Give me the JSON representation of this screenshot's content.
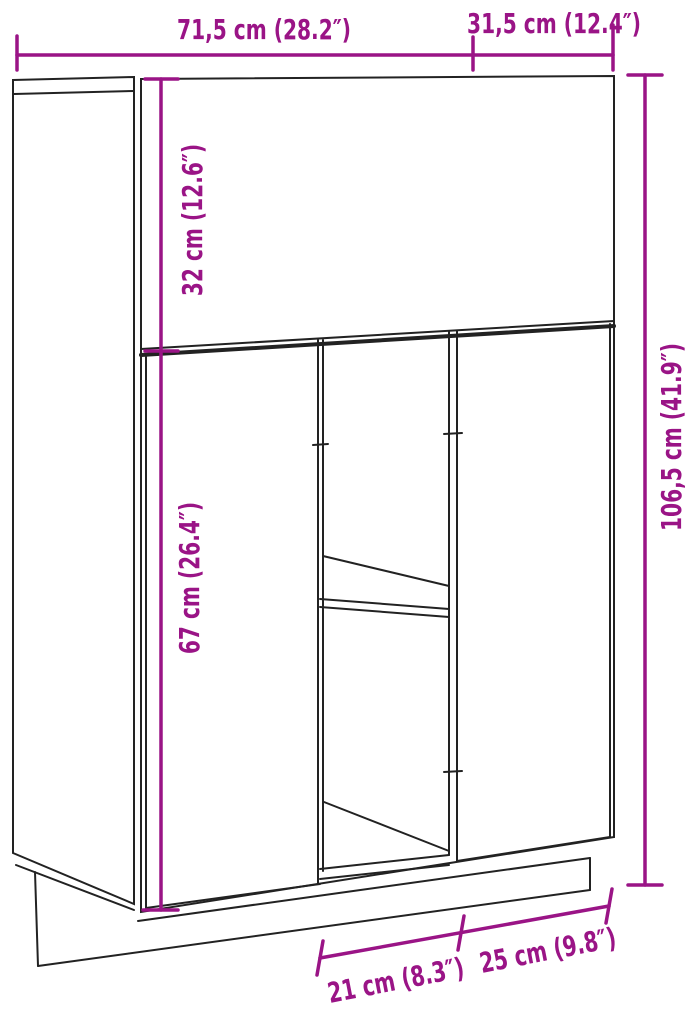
{
  "diagram": {
    "type": "furniture_dimension_diagram",
    "subject": "highboard cabinet technical line drawing, perspective view",
    "colors": {
      "dimension": "#9A1486",
      "outline": "#222222",
      "background": "#FFFFFF"
    },
    "measurements": {
      "width": {
        "label": "71,5 cm (28.2″)",
        "cm": 71.5,
        "in": 28.2
      },
      "depth": {
        "label": "31,5 cm (12.4″)",
        "cm": 31.5,
        "in": 12.4
      },
      "upper_section_height": {
        "label": "32 cm (12.6″)",
        "cm": 32,
        "in": 12.6
      },
      "lower_section_height": {
        "label": "67 cm (26.4″)",
        "cm": 67,
        "in": 26.4
      },
      "total_height": {
        "label": "106,5 cm (41.9″)",
        "cm": 106.5,
        "in": 41.9
      },
      "base_left_width": {
        "label": "21 cm (8.3″)",
        "cm": 21,
        "in": 8.3
      },
      "base_right_width": {
        "label": "25 cm (9.8″)",
        "cm": 25,
        "in": 9.8
      }
    }
  }
}
